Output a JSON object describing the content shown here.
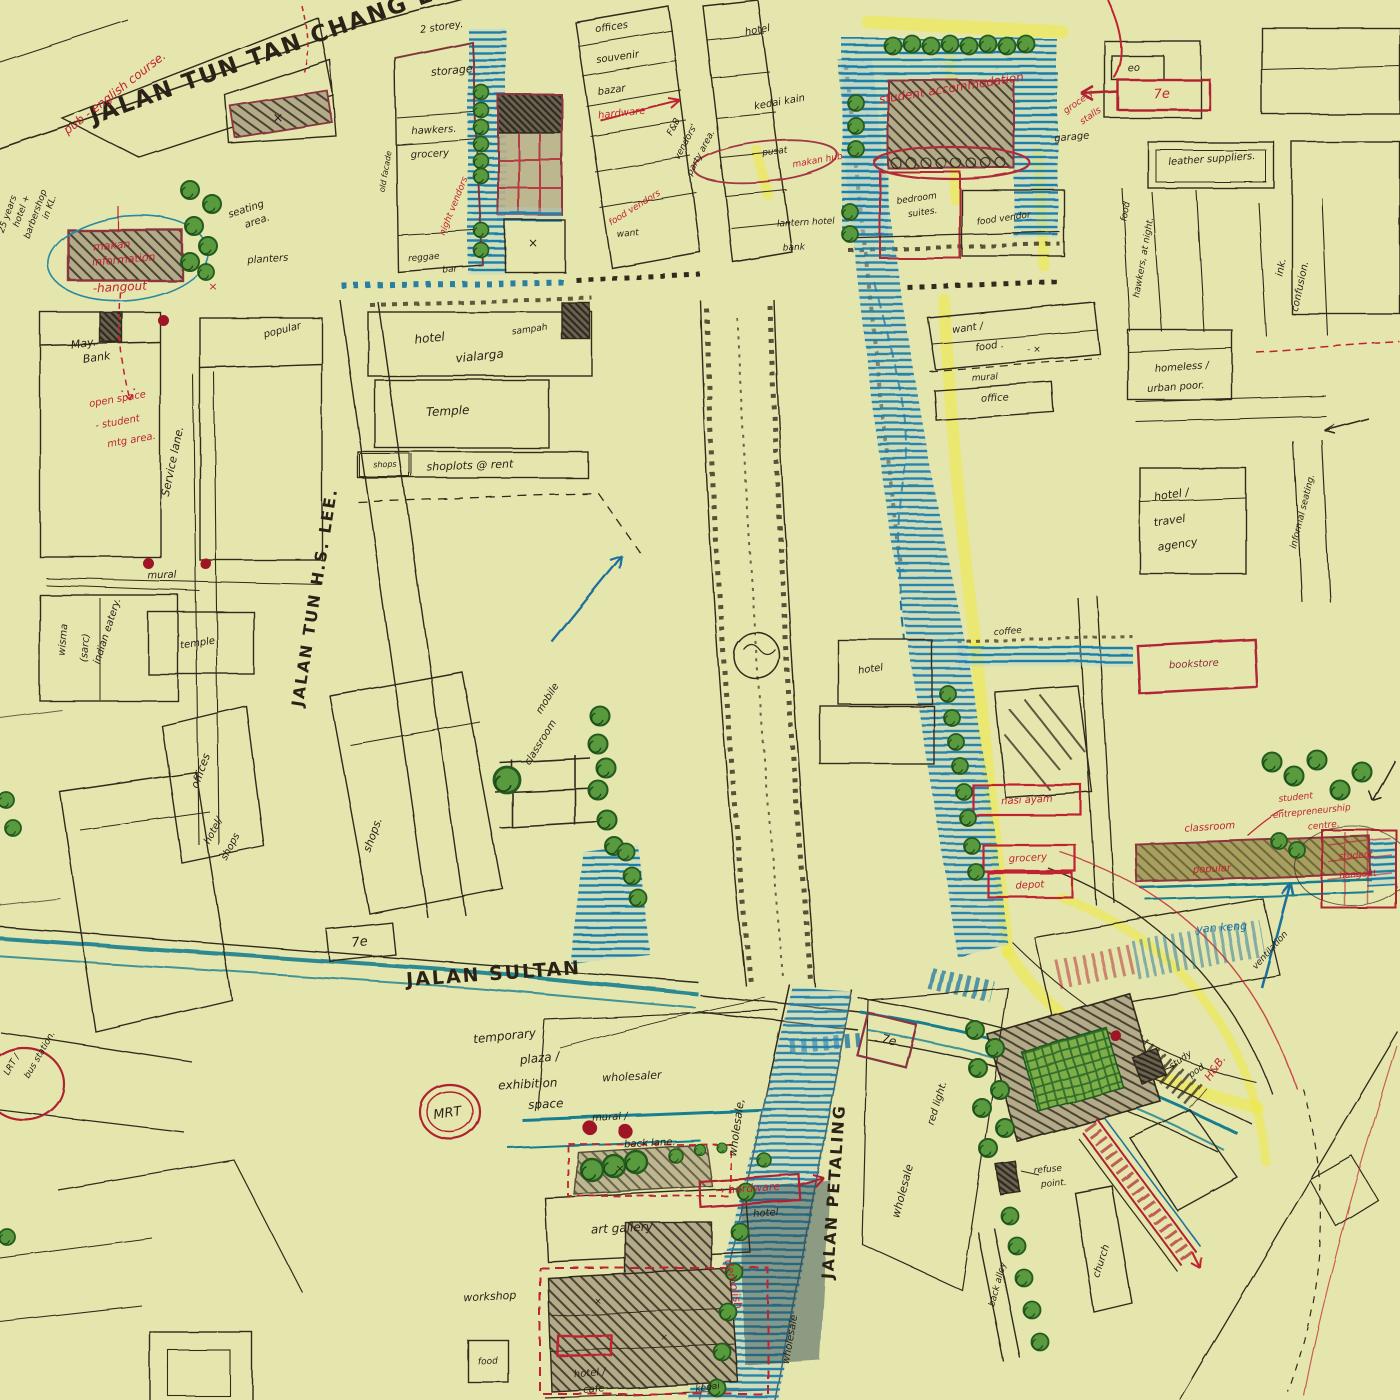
{
  "map": {
    "type": "hand-drawn urban sketch map",
    "streets": [
      "JALAN TUN TAN CHANG LOCK",
      "JALAN TUN H.S. LEE.",
      "JALAN SULTAN",
      "JALAN PETALING"
    ],
    "colors": {
      "paper": "#e4e6ae",
      "ink": "#32291b",
      "red": "#c02330",
      "dark_red": "#8e2e3a",
      "blue": "#1d6f9e",
      "teal": "#177e8f",
      "highlighter": "#eeea40",
      "tree": "#5a9a3f"
    },
    "label_colors": {
      "k": "#2b2217",
      "r": "#c02330",
      "dr": "#8e2e3a",
      "b": "#1d6f9e",
      "t": "#177e8f"
    },
    "labels": [
      {
        "t": "JALAN TUN TAN CHANG LOCK",
        "x": 292,
        "y": 52,
        "r": -20,
        "s": 23,
        "c": "k",
        "b": 1
      },
      {
        "t": "JALAN TUN H.S. LEE.",
        "x": 320,
        "y": 598,
        "r": -81,
        "s": 16,
        "c": "k",
        "b": 1
      },
      {
        "t": "JALAN SULTAN",
        "x": 494,
        "y": 980,
        "r": -4,
        "s": 19,
        "c": "k",
        "b": 1
      },
      {
        "t": "JALAN PETALING",
        "x": 839,
        "y": 1192,
        "r": -86,
        "s": 16,
        "c": "k",
        "b": 1
      },
      {
        "t": "pub - english course.",
        "x": 117,
        "y": 96,
        "r": -38,
        "s": 12,
        "c": "r"
      },
      {
        "t": "25 years",
        "x": 10,
        "y": 215,
        "r": -70,
        "s": 9,
        "c": "k"
      },
      {
        "t": "hotel +",
        "x": 24,
        "y": 212,
        "r": -70,
        "s": 9,
        "c": "k"
      },
      {
        "t": "barbershop",
        "x": 38,
        "y": 215,
        "r": -70,
        "s": 9,
        "c": "k"
      },
      {
        "t": "in KL.",
        "x": 52,
        "y": 208,
        "r": -70,
        "s": 9,
        "c": "k"
      },
      {
        "t": "makan",
        "x": 112,
        "y": 249,
        "r": -5,
        "s": 11,
        "c": "r"
      },
      {
        "t": "information",
        "x": 124,
        "y": 263,
        "r": -5,
        "s": 11,
        "c": "r"
      },
      {
        "t": "-hangout",
        "x": 120,
        "y": 291,
        "r": -3,
        "s": 12,
        "c": "r"
      },
      {
        "t": "seating",
        "x": 247,
        "y": 212,
        "r": -18,
        "s": 10,
        "c": "k"
      },
      {
        "t": "area.",
        "x": 258,
        "y": 224,
        "r": -18,
        "s": 10,
        "c": "k"
      },
      {
        "t": "planters",
        "x": 268,
        "y": 262,
        "r": -4,
        "s": 10,
        "c": "k"
      },
      {
        "t": "×",
        "x": 278,
        "y": 122,
        "r": 0,
        "s": 13,
        "c": "k"
      },
      {
        "t": "×",
        "x": 213,
        "y": 290,
        "r": 0,
        "s": 11,
        "c": "r"
      },
      {
        "t": "May.",
        "x": 84,
        "y": 347,
        "r": -8,
        "s": 11,
        "c": "k"
      },
      {
        "t": "Bank",
        "x": 97,
        "y": 361,
        "r": -8,
        "s": 11,
        "c": "k"
      },
      {
        "t": "open space",
        "x": 118,
        "y": 402,
        "r": -10,
        "s": 10,
        "c": "r"
      },
      {
        "t": "- student",
        "x": 118,
        "y": 425,
        "r": -10,
        "s": 10,
        "c": "r"
      },
      {
        "t": "mtg area.",
        "x": 132,
        "y": 443,
        "r": -10,
        "s": 10,
        "c": "r"
      },
      {
        "t": "Service lane.",
        "x": 176,
        "y": 462,
        "r": -78,
        "s": 11,
        "c": "k"
      },
      {
        "t": "popular",
        "x": 283,
        "y": 333,
        "r": -14,
        "s": 10,
        "c": "k"
      },
      {
        "t": "mural",
        "x": 162,
        "y": 578,
        "r": -2,
        "s": 10,
        "c": "k"
      },
      {
        "t": "wisma",
        "x": 66,
        "y": 640,
        "r": -85,
        "s": 10,
        "c": "k"
      },
      {
        "t": "(sarc)",
        "x": 88,
        "y": 648,
        "r": -85,
        "s": 10,
        "c": "k"
      },
      {
        "t": "indian eatery.",
        "x": 110,
        "y": 632,
        "r": -72,
        "s": 10,
        "c": "k"
      },
      {
        "t": "temple",
        "x": 198,
        "y": 646,
        "r": -8,
        "s": 10,
        "c": "k"
      },
      {
        "t": "offices",
        "x": 204,
        "y": 772,
        "r": -70,
        "s": 11,
        "c": "k"
      },
      {
        "t": "hotel/",
        "x": 216,
        "y": 832,
        "r": -62,
        "s": 10,
        "c": "k"
      },
      {
        "t": "shops",
        "x": 233,
        "y": 848,
        "r": -62,
        "s": 10,
        "c": "k"
      },
      {
        "t": "shops.",
        "x": 376,
        "y": 836,
        "r": -70,
        "s": 11,
        "c": "k"
      },
      {
        "t": "hotel",
        "x": 430,
        "y": 342,
        "r": -6,
        "s": 12,
        "c": "k"
      },
      {
        "t": "vialarga",
        "x": 480,
        "y": 360,
        "r": -6,
        "s": 12,
        "c": "k"
      },
      {
        "t": "sampah",
        "x": 530,
        "y": 332,
        "r": -8,
        "s": 9,
        "c": "k"
      },
      {
        "t": "Temple",
        "x": 448,
        "y": 415,
        "r": -3,
        "s": 12,
        "c": "k"
      },
      {
        "t": "shoplots @ rent",
        "x": 470,
        "y": 469,
        "r": -2,
        "s": 11,
        "c": "k"
      },
      {
        "t": "shops",
        "x": 385,
        "y": 467,
        "r": -2,
        "s": 8,
        "c": "k"
      },
      {
        "t": "7e",
        "x": 360,
        "y": 946,
        "r": -6,
        "s": 13,
        "c": "k"
      },
      {
        "t": "temporary",
        "x": 505,
        "y": 1040,
        "r": -6,
        "s": 12,
        "c": "k"
      },
      {
        "t": "plaza /",
        "x": 540,
        "y": 1062,
        "r": -6,
        "s": 12,
        "c": "k"
      },
      {
        "t": "exhibition",
        "x": 528,
        "y": 1088,
        "r": -3,
        "s": 12,
        "c": "k"
      },
      {
        "t": "space",
        "x": 546,
        "y": 1108,
        "r": -3,
        "s": 12,
        "c": "k"
      },
      {
        "t": "MRT",
        "x": 448,
        "y": 1117,
        "r": -8,
        "s": 13,
        "c": "k"
      },
      {
        "t": "LRT /",
        "x": 14,
        "y": 1066,
        "r": -60,
        "s": 9,
        "c": "k"
      },
      {
        "t": "bus station.",
        "x": 42,
        "y": 1056,
        "r": -60,
        "s": 9,
        "c": "k"
      },
      {
        "t": "wholesaler",
        "x": 632,
        "y": 1080,
        "r": -3,
        "s": 11,
        "c": "k"
      },
      {
        "t": "mural /",
        "x": 610,
        "y": 1120,
        "r": -3,
        "s": 10,
        "c": "k"
      },
      {
        "t": "back lane.",
        "x": 650,
        "y": 1146,
        "r": -3,
        "s": 10,
        "c": "k"
      },
      {
        "t": "art gallery",
        "x": 622,
        "y": 1232,
        "r": -3,
        "s": 12,
        "c": "k"
      },
      {
        "t": "→ hardware",
        "x": 748,
        "y": 1192,
        "r": -4,
        "s": 11,
        "c": "r"
      },
      {
        "t": "hotel",
        "x": 766,
        "y": 1216,
        "r": -4,
        "s": 10,
        "c": "k"
      },
      {
        "t": "demolish",
        "x": 730,
        "y": 1285,
        "r": 78,
        "s": 11,
        "c": "r"
      },
      {
        "t": "workshop",
        "x": 490,
        "y": 1300,
        "r": -3,
        "s": 11,
        "c": "k"
      },
      {
        "t": "food",
        "x": 488,
        "y": 1364,
        "r": -3,
        "s": 9,
        "c": "k"
      },
      {
        "t": "hotel /",
        "x": 590,
        "y": 1376,
        "r": -5,
        "s": 10,
        "c": "k"
      },
      {
        "t": "cafe",
        "x": 594,
        "y": 1392,
        "r": -5,
        "s": 10,
        "c": "k"
      },
      {
        "t": "kedai",
        "x": 708,
        "y": 1390,
        "r": -8,
        "s": 9,
        "c": "k"
      },
      {
        "t": "wholesale,",
        "x": 740,
        "y": 1128,
        "r": -82,
        "s": 11,
        "c": "k"
      },
      {
        "t": "wholesale",
        "x": 906,
        "y": 1192,
        "r": -75,
        "s": 11,
        "c": "k"
      },
      {
        "t": "red light.",
        "x": 940,
        "y": 1104,
        "r": -73,
        "s": 10,
        "c": "k"
      },
      {
        "t": "wholesale",
        "x": 793,
        "y": 1340,
        "r": -80,
        "s": 10,
        "c": "k"
      },
      {
        "t": "7e",
        "x": 888,
        "y": 1044,
        "r": 14,
        "s": 12,
        "c": "k"
      },
      {
        "t": "2 storey.",
        "x": 442,
        "y": 30,
        "r": -8,
        "s": 10,
        "c": "k"
      },
      {
        "t": "storage",
        "x": 452,
        "y": 74,
        "r": -5,
        "s": 11,
        "c": "k"
      },
      {
        "t": "hawkers.",
        "x": 434,
        "y": 133,
        "r": -3,
        "s": 10,
        "c": "k"
      },
      {
        "t": "grocery",
        "x": 430,
        "y": 157,
        "r": -3,
        "s": 10,
        "c": "k"
      },
      {
        "t": "old facade",
        "x": 388,
        "y": 172,
        "r": -80,
        "s": 8,
        "c": "k"
      },
      {
        "t": "night vendors",
        "x": 456,
        "y": 207,
        "r": -68,
        "s": 9,
        "c": "r"
      },
      {
        "t": "reggae",
        "x": 424,
        "y": 260,
        "r": -5,
        "s": 9,
        "c": "k"
      },
      {
        "t": "bar",
        "x": 450,
        "y": 272,
        "r": -5,
        "s": 9,
        "c": "k"
      },
      {
        "t": "offices",
        "x": 612,
        "y": 30,
        "r": -8,
        "s": 10,
        "c": "k"
      },
      {
        "t": "souvenir",
        "x": 618,
        "y": 60,
        "r": -8,
        "s": 10,
        "c": "k"
      },
      {
        "t": "bazar",
        "x": 612,
        "y": 93,
        "r": -8,
        "s": 10,
        "c": "k"
      },
      {
        "t": "hardware",
        "x": 622,
        "y": 116,
        "r": -6,
        "s": 10,
        "c": "r"
      },
      {
        "t": "F&B",
        "x": 676,
        "y": 128,
        "r": -62,
        "s": 9,
        "c": "k"
      },
      {
        "t": "vendors'",
        "x": 688,
        "y": 143,
        "r": -62,
        "s": 9,
        "c": "k"
      },
      {
        "t": "party area.",
        "x": 703,
        "y": 154,
        "r": -62,
        "s": 9,
        "c": "k"
      },
      {
        "t": "want",
        "x": 628,
        "y": 236,
        "r": -5,
        "s": 9,
        "c": "k"
      },
      {
        "t": "food vendors",
        "x": 636,
        "y": 210,
        "r": -32,
        "s": 9,
        "c": "r"
      },
      {
        "t": "hotel",
        "x": 758,
        "y": 33,
        "r": -10,
        "s": 10,
        "c": "k"
      },
      {
        "t": "kedai kain",
        "x": 780,
        "y": 105,
        "r": -10,
        "s": 10,
        "c": "k"
      },
      {
        "t": "pusat",
        "x": 775,
        "y": 154,
        "r": -6,
        "s": 9,
        "c": "k"
      },
      {
        "t": "makan hub",
        "x": 818,
        "y": 163,
        "r": -10,
        "s": 9,
        "c": "r"
      },
      {
        "t": "lantern hotel",
        "x": 806,
        "y": 225,
        "r": -3,
        "s": 9,
        "c": "k"
      },
      {
        "t": "bank",
        "x": 794,
        "y": 250,
        "r": -3,
        "s": 9,
        "c": "k"
      },
      {
        "t": "student accommodation",
        "x": 952,
        "y": 92,
        "r": -9,
        "s": 12,
        "c": "r"
      },
      {
        "t": "bedroom",
        "x": 917,
        "y": 201,
        "r": -8,
        "s": 9,
        "c": "k"
      },
      {
        "t": "suites.",
        "x": 923,
        "y": 215,
        "r": -8,
        "s": 9,
        "c": "k"
      },
      {
        "t": "food vendor",
        "x": 1004,
        "y": 221,
        "r": -8,
        "s": 9,
        "c": "k"
      },
      {
        "t": "garage",
        "x": 1072,
        "y": 140,
        "r": -5,
        "s": 10,
        "c": "k"
      },
      {
        "t": "eo",
        "x": 1134,
        "y": 71,
        "r": -3,
        "s": 10,
        "c": "k"
      },
      {
        "t": "7e",
        "x": 1162,
        "y": 98,
        "r": -3,
        "s": 13,
        "c": "r"
      },
      {
        "t": "grocery",
        "x": 1080,
        "y": 104,
        "r": -35,
        "s": 9,
        "c": "r"
      },
      {
        "t": "stalls",
        "x": 1092,
        "y": 118,
        "r": -35,
        "s": 9,
        "c": "r"
      },
      {
        "t": "leather suppliers.",
        "x": 1212,
        "y": 162,
        "r": -4,
        "s": 10,
        "c": "k"
      },
      {
        "t": "food",
        "x": 1128,
        "y": 212,
        "r": -80,
        "s": 9,
        "c": "k"
      },
      {
        "t": "hawkers, at night.",
        "x": 1146,
        "y": 258,
        "r": -80,
        "s": 9,
        "c": "k"
      },
      {
        "t": "ink.",
        "x": 1284,
        "y": 268,
        "r": -78,
        "s": 10,
        "c": "k"
      },
      {
        "t": "confusion.",
        "x": 1303,
        "y": 287,
        "r": -78,
        "s": 10,
        "c": "k"
      },
      {
        "t": "want /",
        "x": 968,
        "y": 331,
        "r": -8,
        "s": 10,
        "c": "k"
      },
      {
        "t": "food .",
        "x": 990,
        "y": 349,
        "r": -8,
        "s": 10,
        "c": "k"
      },
      {
        "t": "- ×",
        "x": 1034,
        "y": 352,
        "r": 0,
        "s": 9,
        "c": "k"
      },
      {
        "t": "mural",
        "x": 985,
        "y": 380,
        "r": -4,
        "s": 9,
        "c": "k"
      },
      {
        "t": "office",
        "x": 995,
        "y": 401,
        "r": -3,
        "s": 10,
        "c": "k"
      },
      {
        "t": "homeless /",
        "x": 1182,
        "y": 370,
        "r": -4,
        "s": 10,
        "c": "k"
      },
      {
        "t": "urban poor.",
        "x": 1176,
        "y": 390,
        "r": -4,
        "s": 10,
        "c": "k"
      },
      {
        "t": "hotel /",
        "x": 1172,
        "y": 498,
        "r": -8,
        "s": 11,
        "c": "k"
      },
      {
        "t": "travel",
        "x": 1170,
        "y": 524,
        "r": -8,
        "s": 11,
        "c": "k"
      },
      {
        "t": "agency",
        "x": 1178,
        "y": 548,
        "r": -8,
        "s": 11,
        "c": "k"
      },
      {
        "t": "informal seating.",
        "x": 1305,
        "y": 512,
        "r": -76,
        "s": 9,
        "c": "k"
      },
      {
        "t": "coffee",
        "x": 1008,
        "y": 634,
        "r": -5,
        "s": 9,
        "c": "k"
      },
      {
        "t": "bookstore",
        "x": 1194,
        "y": 667,
        "r": -3,
        "s": 10,
        "c": "dr"
      },
      {
        "t": "hotel",
        "x": 871,
        "y": 672,
        "r": -8,
        "s": 10,
        "c": "k"
      },
      {
        "t": "nasi ayam",
        "x": 1027,
        "y": 803,
        "r": -3,
        "s": 10,
        "c": "r"
      },
      {
        "t": "grocery",
        "x": 1028,
        "y": 861,
        "r": -3,
        "s": 10,
        "c": "r"
      },
      {
        "t": "depot",
        "x": 1030,
        "y": 888,
        "r": -3,
        "s": 10,
        "c": "r"
      },
      {
        "t": "classroom",
        "x": 1210,
        "y": 830,
        "r": -4,
        "s": 10,
        "c": "r"
      },
      {
        "t": "popular",
        "x": 1212,
        "y": 872,
        "r": -3,
        "s": 10,
        "c": "r"
      },
      {
        "t": "student",
        "x": 1296,
        "y": 800,
        "r": -6,
        "s": 9,
        "c": "r"
      },
      {
        "t": "entrepreneurship",
        "x": 1312,
        "y": 814,
        "r": -6,
        "s": 9,
        "c": "r"
      },
      {
        "t": "centre.",
        "x": 1324,
        "y": 828,
        "r": -6,
        "s": 9,
        "c": "r"
      },
      {
        "t": "student",
        "x": 1356,
        "y": 858,
        "r": -4,
        "s": 9,
        "c": "r"
      },
      {
        "t": "hangout",
        "x": 1358,
        "y": 877,
        "r": -4,
        "s": 9,
        "c": "r"
      },
      {
        "t": "yan keng",
        "x": 1222,
        "y": 931,
        "r": -4,
        "s": 11,
        "c": "b"
      },
      {
        "t": "ventilation",
        "x": 1272,
        "y": 952,
        "r": -48,
        "s": 9,
        "c": "k"
      },
      {
        "t": "study",
        "x": 1182,
        "y": 1062,
        "r": -35,
        "s": 9,
        "c": "k"
      },
      {
        "t": "pod",
        "x": 1198,
        "y": 1073,
        "r": -35,
        "s": 9,
        "c": "k"
      },
      {
        "t": "H&B.",
        "x": 1218,
        "y": 1070,
        "r": -55,
        "s": 11,
        "c": "r"
      },
      {
        "t": "refuse",
        "x": 1048,
        "y": 1172,
        "r": -5,
        "s": 9,
        "c": "k"
      },
      {
        "t": "point.",
        "x": 1054,
        "y": 1186,
        "r": -5,
        "s": 9,
        "c": "k"
      },
      {
        "t": "church",
        "x": 1104,
        "y": 1262,
        "r": -72,
        "s": 10,
        "c": "k"
      },
      {
        "t": "back alley",
        "x": 1000,
        "y": 1285,
        "r": -75,
        "s": 9,
        "c": "k"
      },
      {
        "t": "mobile",
        "x": 550,
        "y": 700,
        "r": -58,
        "s": 10,
        "c": "k"
      },
      {
        "t": "classroom",
        "x": 543,
        "y": 744,
        "r": -58,
        "s": 10,
        "c": "k"
      },
      {
        "t": "×",
        "x": 533,
        "y": 247,
        "r": 0,
        "s": 12,
        "c": "k"
      },
      {
        "t": "×",
        "x": 620,
        "y": 1172,
        "r": 0,
        "s": 11,
        "c": "k"
      },
      {
        "t": "×",
        "x": 598,
        "y": 1304,
        "r": 0,
        "s": 9,
        "c": "k"
      },
      {
        "t": "×",
        "x": 664,
        "y": 1340,
        "r": 0,
        "s": 9,
        "c": "k"
      }
    ]
  }
}
